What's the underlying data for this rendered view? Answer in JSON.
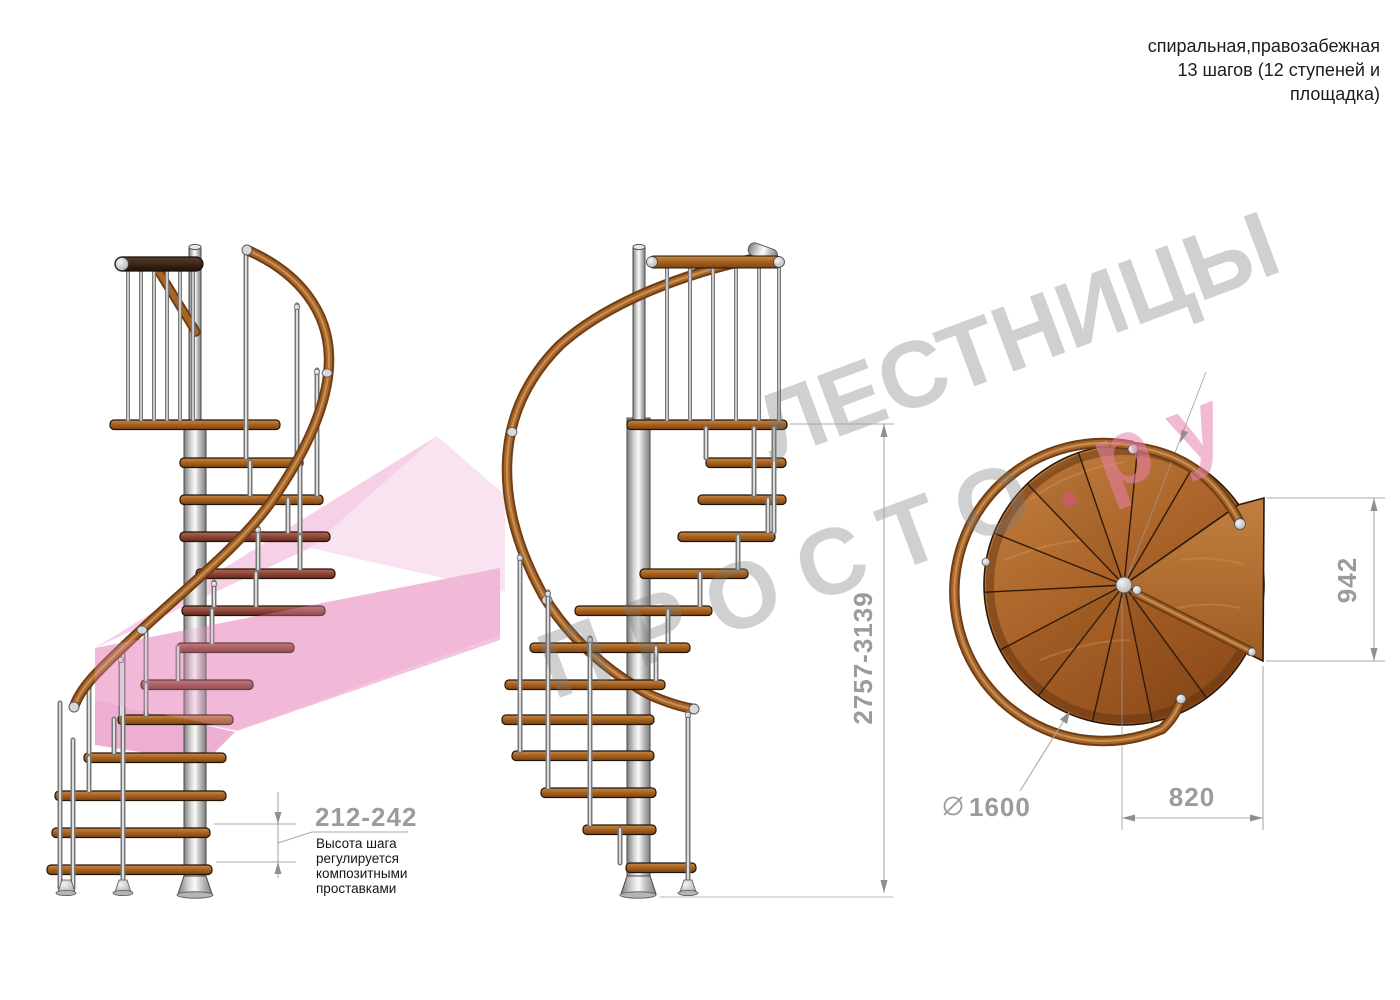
{
  "header": {
    "line1": "спиральная,правозабежная",
    "line2": "13 шагов (12 ступеней и",
    "line3": "площадка)"
  },
  "watermark": {
    "word1": "ЛЕСТНИЦЫ",
    "word2": "ПРОСТО",
    "dot": ".",
    "suffix": "ру",
    "gray": "#787878",
    "pink": "#e87fae",
    "dot_pink": "#e0508c",
    "ribbon_pink": "#f3c4de"
  },
  "annotations": {
    "step_height": {
      "value": "212-242",
      "note_line1": "Высота шага",
      "note_line2": "регулируется",
      "note_line3": "композитными",
      "note_line4": "проставками"
    },
    "total_height": {
      "value": "2757-3139"
    },
    "platform_depth": {
      "value": "942"
    },
    "platform_offset": {
      "value": "820"
    },
    "diameter": {
      "value": "1600"
    }
  },
  "colors": {
    "wood": "#a4601f",
    "wood_dark": "#6f3d15",
    "rail_mid": "#a56428",
    "metal": "#c9c9c9",
    "dim_line": "#a8a8a8",
    "dim_text": "#9b9b9b"
  }
}
